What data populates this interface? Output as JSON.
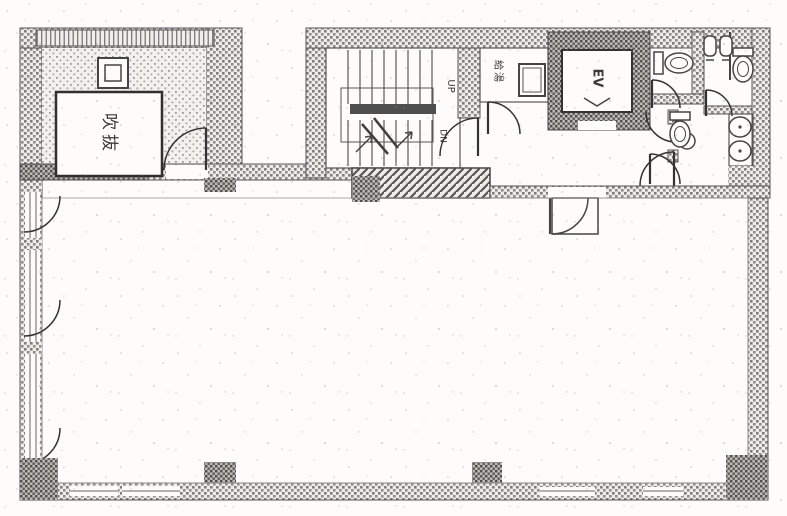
{
  "plan": {
    "labels": {
      "void": "吹抜",
      "up": "UP",
      "down": "DN",
      "elevator": "EV",
      "kitchenette": "給湯"
    },
    "colors": {
      "paper": "#fdfcfa",
      "ink": "#3d3d3d",
      "wall_hatch": "#7d7d7d",
      "dark_hatch": "#4e4e4e"
    }
  }
}
